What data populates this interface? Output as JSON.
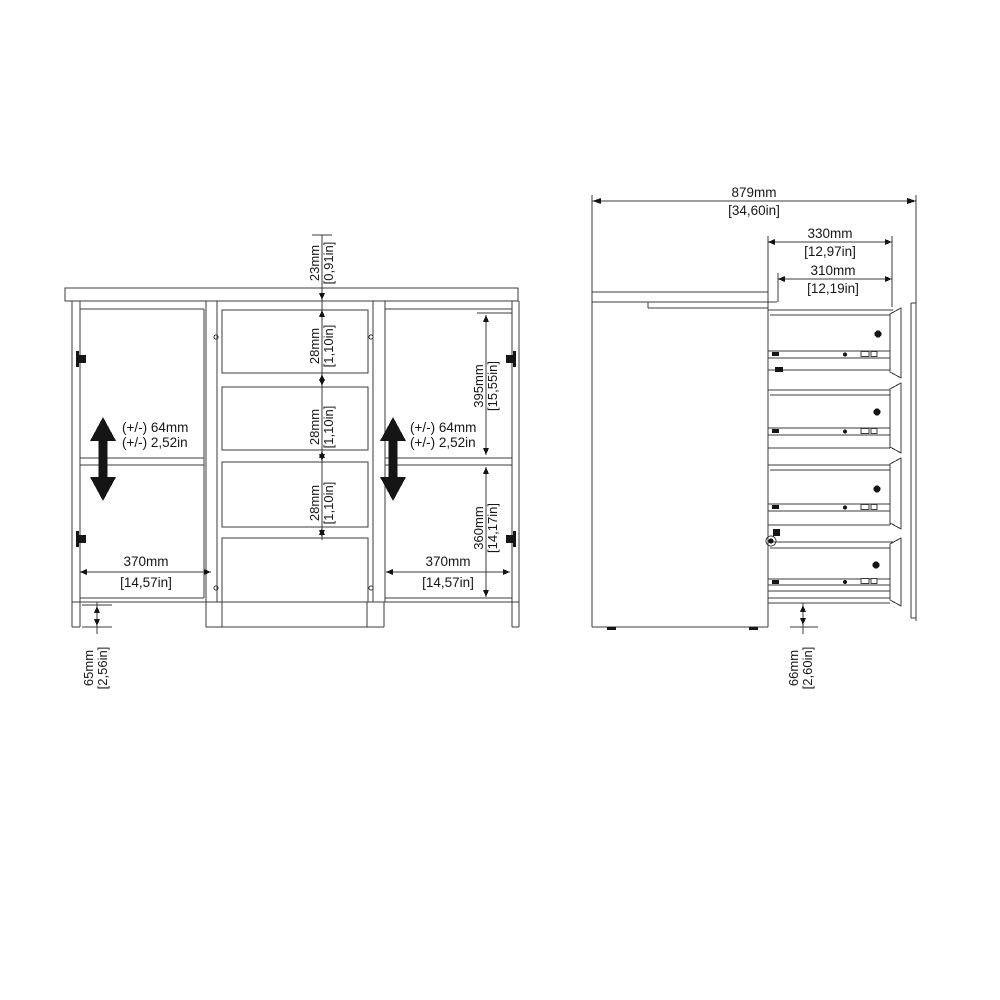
{
  "figure": {
    "type": "furniture-assembly-dimension-diagram",
    "views": [
      "front-view",
      "side-view-drawers-extended"
    ]
  },
  "front_view": {
    "top_gap": {
      "mm": "23mm",
      "in": "[0,91in]"
    },
    "drawer_gaps": [
      {
        "mm": "28mm",
        "in": "[1,10in]"
      },
      {
        "mm": "28mm",
        "in": "[1,10in]"
      },
      {
        "mm": "28mm",
        "in": "[1,10in]"
      }
    ],
    "shelf_adjust_left": {
      "line1": "(+/-) 64mm",
      "line2": "(+/-) 2,52in"
    },
    "shelf_adjust_right": {
      "line1": "(+/-) 64mm",
      "line2": "(+/-) 2,52in"
    },
    "upper_section_height": {
      "mm": "395mm",
      "in": "[15,55in]"
    },
    "lower_section_height": {
      "mm": "360mm",
      "in": "[14,17in]"
    },
    "left_door_width": {
      "mm": "370mm",
      "in": "[14,57in]"
    },
    "right_door_width": {
      "mm": "370mm",
      "in": "[14,57in]"
    },
    "plinth_height": {
      "mm": "65mm",
      "in": "[2,56in]"
    }
  },
  "side_view": {
    "total_depth": {
      "mm": "879mm",
      "in": "[34,60in]"
    },
    "drawer_depth": {
      "mm": "330mm",
      "in": "[12,97in]"
    },
    "drawer_inner_depth": {
      "mm": "310mm",
      "in": "[12,19in]"
    },
    "plinth_height": {
      "mm": "66mm",
      "in": "[2,60in]"
    }
  },
  "colors": {
    "line": "#3b3b3b",
    "solid": "#151515",
    "text": "#161616",
    "background": "#ffffff"
  }
}
